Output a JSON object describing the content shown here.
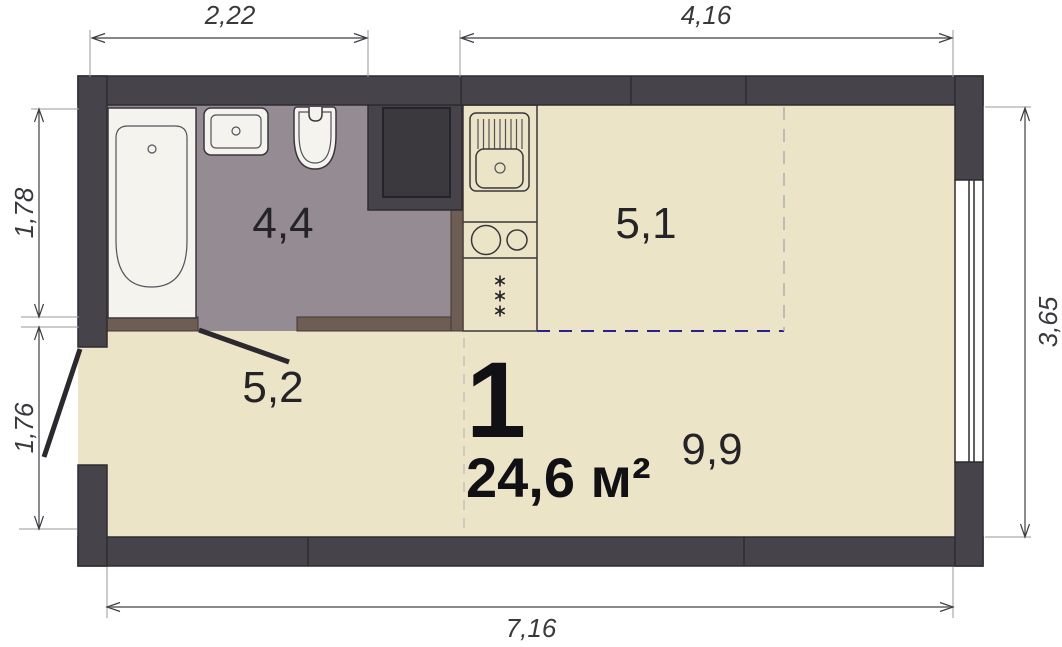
{
  "plan": {
    "unit": {
      "number": "1",
      "total_area": "24,6 м²"
    },
    "rooms": [
      {
        "name": "bathroom",
        "area": "4,4"
      },
      {
        "name": "kitchen-zone",
        "area": "5,1"
      },
      {
        "name": "entry-zone",
        "area": "5,2"
      },
      {
        "name": "living-zone",
        "area": "9,9"
      }
    ],
    "dimensions": {
      "top_bathroom": "2,22",
      "top_room": "4,16",
      "left_bathroom": "1,78",
      "left_entry": "1,76",
      "right_room": "3,65",
      "bottom_total": "7,16"
    }
  },
  "colors": {
    "background": "#FFFFFF",
    "wall": "#46434A",
    "shaft": "#3B383E",
    "floor": "#ECE4C6",
    "bathroom_floor": "#948B93",
    "partition_brown": "#6E5D52",
    "fixture_white": "#F4F2EB",
    "zone_dashed_blue": "#2A2090",
    "zone_dashed_gray": "#AFAFB5",
    "outline": "#3A383D"
  }
}
